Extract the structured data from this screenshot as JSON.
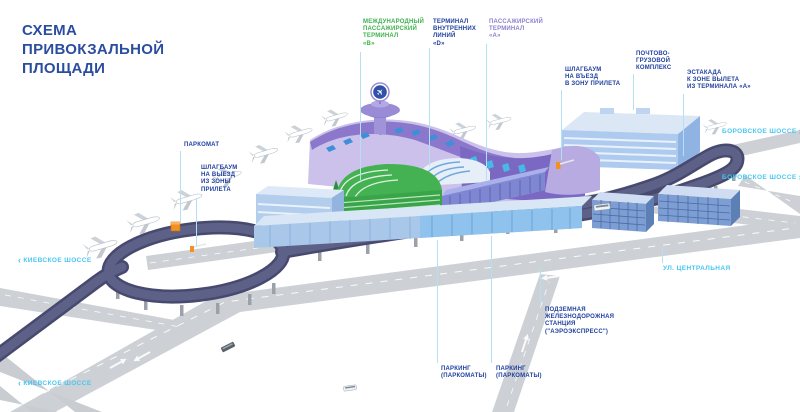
{
  "title": "СХЕМА\nПРИВОКЗАЛЬНОЙ\nПЛОЩАДИ",
  "colors": {
    "title_blue": "#2b4da0",
    "label_blue": "#21409f",
    "label_green": "#3db14c",
    "label_purple": "#8e80cf",
    "road_label_cyan": "#47c7f2",
    "leader_line": "#b3e0f4",
    "elevated_road": "#5d6087",
    "ground_road": "#cdd1d6",
    "terminal_a_purple": "#8b78cc",
    "terminal_b_green": "#44b152",
    "buildings_blue": "#aecbef",
    "accent_orange": "#f39120"
  },
  "legend_labels": {
    "terminal_b": "МЕЖДУНАРОДНЫЙ\nПАССАЖИРСКИЙ\nТЕРМИНАЛ\n«B»",
    "terminal_d": "ТЕРМИНАЛ\nВНУТРЕННИХ\nЛИНИЙ\n«D»",
    "terminal_a": "ПАССАЖИРСКИЙ\nТЕРМИНАЛ\n«А»",
    "barrier_entry": "ШЛАГБАУМ\nНА ВЪЕЗД\nВ ЗОНУ ПРИЛЕТА",
    "cargo_complex": "ПОЧТОВО-\nГРУЗОВОЙ\nКОМПЛЕКС",
    "overpass": "ЭСТАКАДА\nК ЗОНЕ ВЫЛЕТА\nИЗ ТЕРМИНАЛА «А»",
    "parkomat": "ПАРКОМАТ",
    "barrier_exit": "ШЛАГБАУМ\nНА ВЫЕЗД\nИЗ ЗОНЫ\nПРИЛЕТА",
    "parking_1": "ПАРКИНГ\n(ПАРКОМАТЫ)",
    "parking_2": "ПАРКИНГ\n(ПАРКОМАТЫ)",
    "rail_station": "ПОДЗЕМНАЯ\nЖЕЛЕЗНОДОРОЖНАЯ\nСТАНЦИЯ\n(\"АЭРОЭКСПРЕСС\")"
  },
  "road_labels": {
    "borovskoe_1": "БОРОВСКОЕ ШОССЕ",
    "borovskoe_2": "БОРОВСКОЕ ШОССЕ",
    "kievskoe_1": "КИЕВСКОЕ ШОССЕ",
    "kievskoe_2": "КИЕВСКОЕ ШОССЕ",
    "central_street": "УЛ. ЦЕНТРАЛЬНАЯ",
    "chevron_right": "›",
    "chevron_left": "‹"
  },
  "icons": {
    "airplane_logo": "✈"
  }
}
